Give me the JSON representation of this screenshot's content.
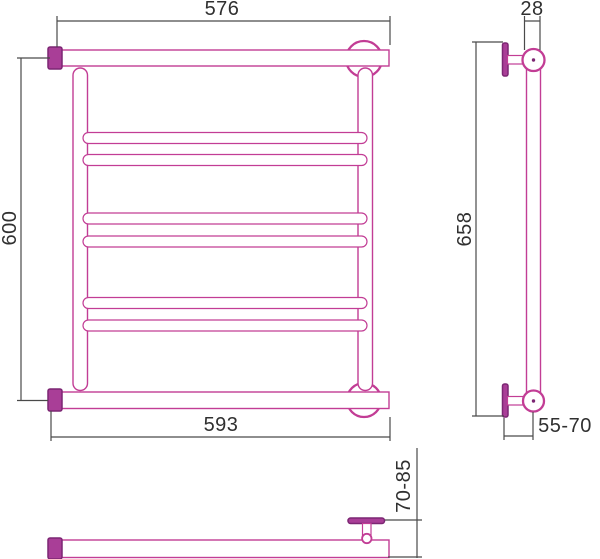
{
  "drawing": {
    "kind": "heated-towel-rail-technical-drawing",
    "colors": {
      "outline_pink": "#c23d95",
      "solid_fill": "#a93e97",
      "solid_border": "#7c2673",
      "dimension_line": "#4a4a4a",
      "label_text": "#303030",
      "background": "#ffffff"
    },
    "views": {
      "front": {
        "rung_count": 6,
        "dims": {
          "top_width": "576",
          "height": "600",
          "bottom_width": "593"
        }
      },
      "side": {
        "dims": {
          "tube_diameter": "28",
          "height": "658",
          "wall_offset": "55-70"
        }
      },
      "plan": {
        "dims": {
          "wall_depth": "70-85"
        }
      }
    }
  }
}
